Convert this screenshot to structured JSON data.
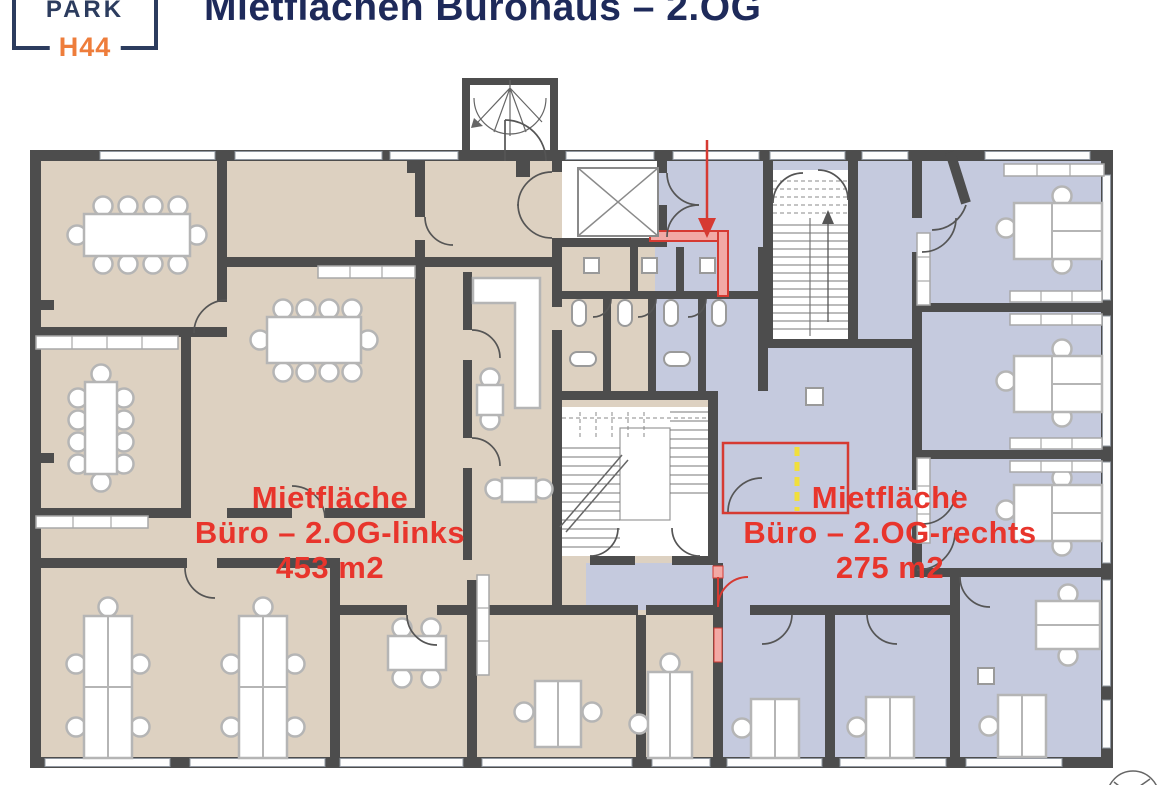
{
  "header": {
    "logo_line1": "PARK",
    "logo_line2": "H44",
    "title": "Mietflächen Bürohaus – 2.OG"
  },
  "zones": {
    "left": {
      "name": "Mietfläche",
      "descriptor": "Büro – 2.OG-links",
      "area": "453 m2",
      "fill_color": "#ddd1c1"
    },
    "right": {
      "name": "Mietfläche",
      "descriptor": "Büro – 2.OG-rechts",
      "area": "275 m2",
      "fill_color": "#c5cade"
    }
  },
  "colors": {
    "title_navy": "#1e2a5a",
    "logo_navy": "#2c3c5e",
    "logo_orange": "#ee7d3b",
    "label_red": "#e8352c",
    "wall_gray": "#4d4d4d",
    "boundary_red": "#d63a32",
    "boundary_red_fill": "#f2a9a5",
    "marker_yellow": "#f1df3c"
  }
}
